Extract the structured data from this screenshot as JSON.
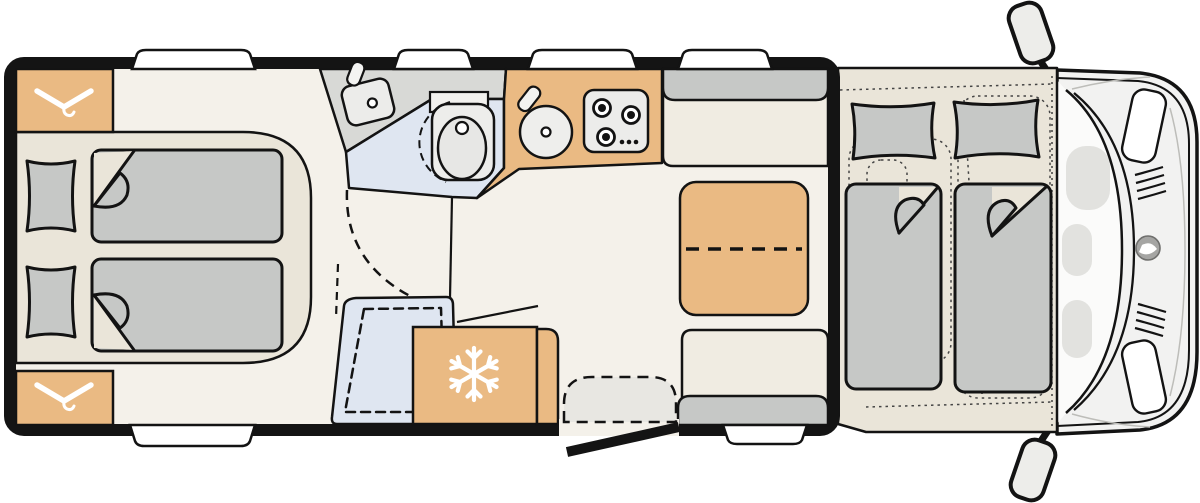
{
  "meta": {
    "title": "Motorhome floor plan",
    "type": "floor-plan",
    "view": "top-down",
    "visible_text": ""
  },
  "colors": {
    "background": "#ffffff",
    "wall": "#141414",
    "outline": "#131313",
    "floor": "#f4f1ea",
    "platform": "#eae5d9",
    "bench_seat": "#f0ece2",
    "furniture_wood": "#eaba83",
    "fabric_grey": "#c6c8c6",
    "washroom_floor": "#d8d9d6",
    "wetroom_blue": "#dfe6f1",
    "appliance_grey": "#ececea",
    "step_grey": "#e8e7e2",
    "cab_body": "#f2f2f1",
    "cab_glass": "#fbfbfa",
    "cab_detail": "#e2e2df",
    "logo_grey": "#a5a5a3",
    "window_white": "#ffffff"
  },
  "icons": [
    {
      "name": "hanger-icon",
      "meaning": "wardrobe"
    },
    {
      "name": "snowflake-icon",
      "meaning": "refrigerator"
    },
    {
      "name": "burner-icon",
      "meaning": "gas hob burner"
    },
    {
      "name": "brand-logo-icon",
      "meaning": "vehicle brand badge on cab front"
    }
  ],
  "plan": {
    "rear_bedroom": {
      "beds": 2,
      "pillows": 2,
      "wardrobes": 2
    },
    "washroom": {
      "fixtures": [
        "washbasin",
        "toilet"
      ]
    },
    "shower": {
      "fixtures": [
        "shower tray with drain"
      ]
    },
    "kitchen": {
      "fixtures": [
        "round sink",
        "3-burner hob"
      ],
      "burners": 3,
      "control_knobs": 3
    },
    "refrigerator": {
      "icon": "snowflake-icon"
    },
    "dinette": {
      "benches": 2,
      "tables": 1,
      "table_extendable": true
    },
    "entry": {
      "doors": 1,
      "steps": 1
    },
    "front_bedroom": {
      "beds": 2,
      "pillows": 2,
      "cab_seats_dotted": 2
    },
    "cab": {
      "mirrors": 2,
      "headlights": 2,
      "grille_groups": 2
    },
    "windows_top": 4,
    "windows_bottom": 2
  }
}
